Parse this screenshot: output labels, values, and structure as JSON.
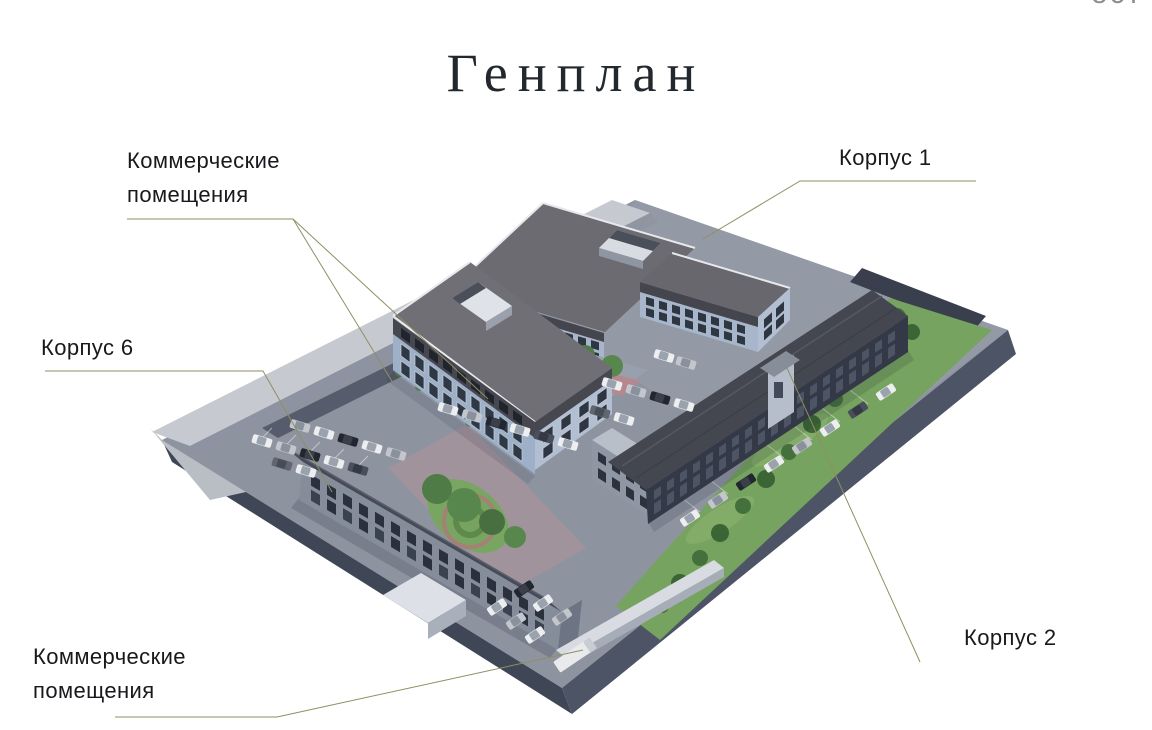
{
  "header": {
    "title": "Генплан",
    "logo_fragment": "ост"
  },
  "annotations": {
    "commercial_top": {
      "line1": "Коммерческие",
      "line2": "помещения"
    },
    "korpus_1": {
      "label": "Корпус 1"
    },
    "korpus_6": {
      "label": "Корпус 6"
    },
    "korpus_2": {
      "label": "Корпус 2"
    },
    "commercial_bottom": {
      "line1": "Коммерческие",
      "line2": "помещения"
    }
  },
  "colors": {
    "background": "#ffffff",
    "title_text": "#22282e",
    "label_text": "#17191c",
    "leader_line": "#8f8f62",
    "logo_text": "#8d8d8d",
    "render": {
      "asphalt": "#8e93a0",
      "plinth_side": "#454c5d",
      "perimeter_wall": "#c6c9cf",
      "lawn": "#76a35f",
      "tree": "#44703c",
      "facade_light": "#9db0c7",
      "brick_dark": "#343947",
      "roof_grey": "#6f6f75",
      "roof_dark": "#44474f",
      "white_detail": "#dde1e7"
    }
  }
}
